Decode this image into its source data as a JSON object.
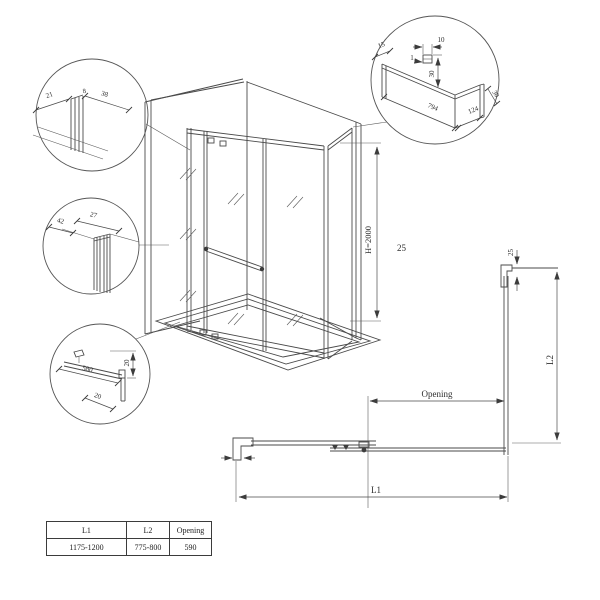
{
  "drawing": {
    "detail_top_left": {
      "dim_left": "21",
      "dim_mid": "8",
      "dim_right": "38"
    },
    "detail_mid_left": {
      "dim_side": "42",
      "dim_width": "27"
    },
    "detail_bottom_left": {
      "dim_length": "580",
      "dim_height": "20",
      "dim_depth": "20"
    },
    "detail_top_right": {
      "dim_edge": "15",
      "dim_clip_width": "10",
      "dim_clip_gap": "1",
      "dim_drop": "30",
      "dim_length": "794",
      "dim_end": "124",
      "dim_end_height": "30"
    },
    "iso": {
      "height_label": "H=2000",
      "note_25": "25"
    },
    "plan": {
      "profile_dim": "25",
      "opening_label": "Opening",
      "l1_label": "L1",
      "l2_label": "L2"
    }
  },
  "table": {
    "headers": [
      "L1",
      "L2",
      "Opening"
    ],
    "rows": [
      [
        "1175-1200",
        "775-800",
        "590"
      ]
    ]
  }
}
